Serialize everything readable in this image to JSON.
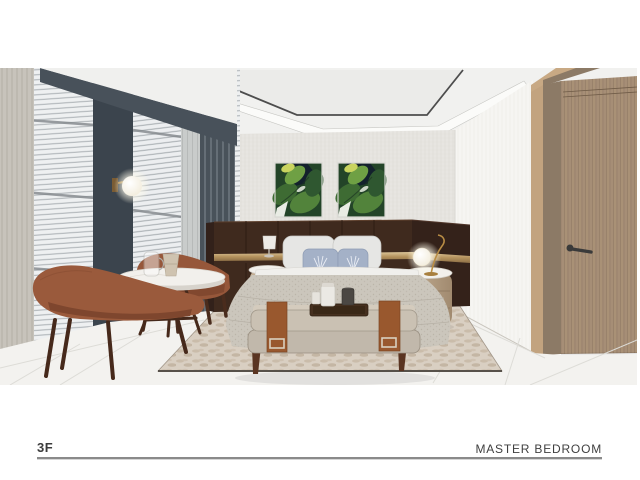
{
  "page": {
    "background": "#ffffff",
    "footer": {
      "floor_label": "3F",
      "room_label": "MASTER BEDROOM",
      "rule_color": "#8a8a8a",
      "text_color": "#3b3b3b"
    },
    "render": {
      "description": "3D interior rendering of a master bedroom",
      "objects": [
        "window-blinds",
        "curtains",
        "wall-sconce",
        "lounge-chairs",
        "coffee-table",
        "botanical-artwork",
        "headboard-panel",
        "bed",
        "pillows",
        "nightstands",
        "globe-table-lamp",
        "storage-bench",
        "serving-tray",
        "area-rug",
        "tile-floor",
        "wooden-door",
        "ceiling-cove"
      ],
      "palette": {
        "ceiling": "#f1f1ef",
        "back_wall": "#e7e5e1",
        "dark_accent_panel": "#3b444d",
        "headboard_wood": "#3f2a1e",
        "brass_trim": "#b6945f",
        "chair_upholstery": "#9a5a3c",
        "door_wood": "#a68e76",
        "artwork_green": "#3e6b33",
        "rug": "#d9cfc2",
        "floor_tile": "#f3f2ef"
      }
    }
  }
}
